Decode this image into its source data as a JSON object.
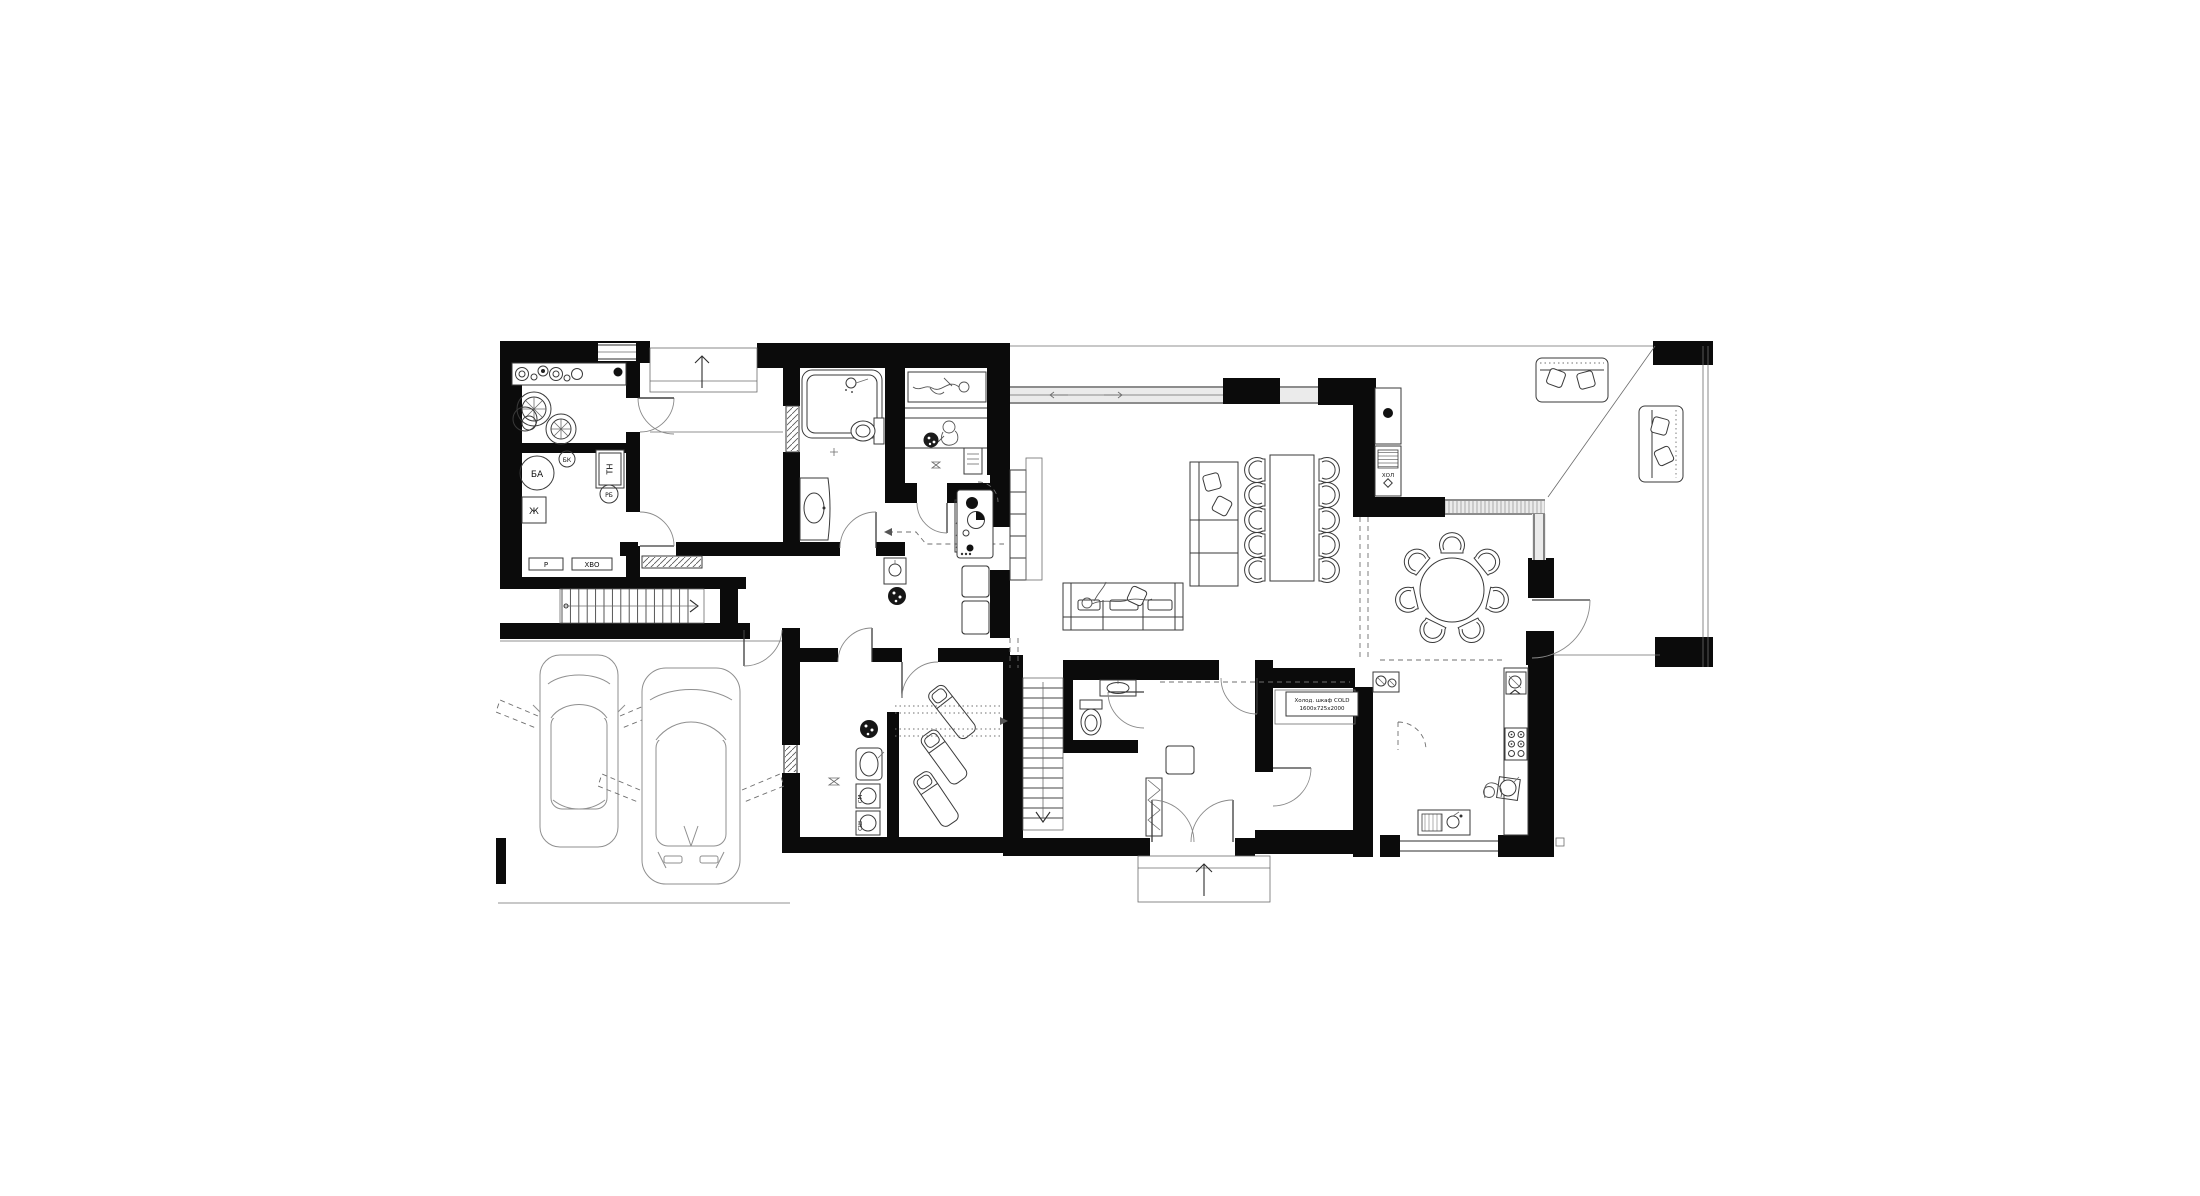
{
  "page": {
    "background": "#ffffff"
  },
  "plan": {
    "colors": {
      "wall": "#0b0b0b",
      "line": "#2e2e2e",
      "glass": "#ebebeb"
    },
    "labels": {
      "buffer_tank": "БА",
      "small_boiler": "БК",
      "heat_pump": "ТН",
      "expansion_tank": "РБ",
      "meter": "Ж",
      "pump": "Р",
      "water_treatment": "ХВО",
      "fridge": "ХОЛ",
      "washer": "СМ",
      "dryer": "СШ",
      "cold_cabinet_line1": "Холод. шкаф COLD",
      "cold_cabinet_line2": "1600х725х2000"
    }
  }
}
